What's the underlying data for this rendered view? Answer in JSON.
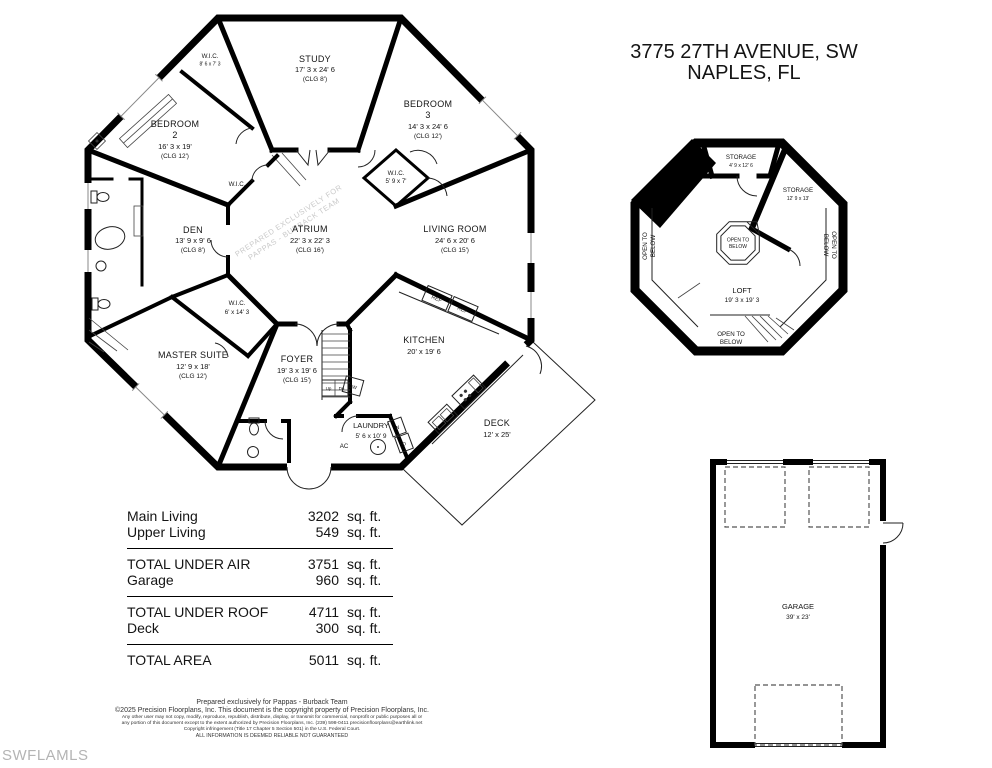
{
  "address": {
    "line1": "3775 27TH AVENUE, SW",
    "line2": "NAPLES, FL"
  },
  "mls_watermark": "SWFLAMLS",
  "main_floor": {
    "watermark": {
      "line1": "PREPARED EXCLUSIVELY FOR",
      "line2": "PAPPAS - BURBACK TEAM"
    },
    "rooms": {
      "study": {
        "name": "STUDY",
        "dims": "17' 3 x 24' 6",
        "clg": "(CLG 8')"
      },
      "bedroom2": {
        "name": "BEDROOM",
        "number": "2",
        "dims": "16' 3 x 19'",
        "clg": "(CLG 12')"
      },
      "bedroom3": {
        "name": "BEDROOM",
        "number": "3",
        "dims": "14' 3 x 24' 6",
        "clg": "(CLG 12')"
      },
      "wic_top": {
        "name": "W.I.C.",
        "dims": "8' 6 x 7' 3"
      },
      "wic_hall": {
        "name": "W.I.C."
      },
      "wic_bed3": {
        "name": "W.I.C.",
        "dims": "5' 9 x 7'"
      },
      "den": {
        "name": "DEN",
        "dims": "13' 9 x 9' 6",
        "clg": "(CLG 8')"
      },
      "atrium": {
        "name": "ATRIUM",
        "dims": "22' 3 x 22' 3",
        "clg": "(CLG 16')"
      },
      "living_room": {
        "name": "LIVING ROOM",
        "dims": "24' 6 x 20' 6",
        "clg": "(CLG 15')"
      },
      "wic_master": {
        "name": "W.I.C.",
        "dims": "6' x 14' 3"
      },
      "master_suite": {
        "name": "MASTER SUITE",
        "dims": "12' 9 x 18'",
        "clg": "(CLG 12')"
      },
      "foyer": {
        "name": "FOYER",
        "dims": "19' 3 x 19' 6",
        "clg": "(CLG 15')"
      },
      "kitchen": {
        "name": "KITCHEN",
        "dims": "20' x 19' 6"
      },
      "laundry": {
        "name": "LAUNDRY",
        "dims": "5' 6 x 10' 9"
      },
      "deck": {
        "name": "DECK",
        "dims": "12' x 25'"
      }
    },
    "labels": {
      "ref": "REF",
      "dw": "DW",
      "washer": "W",
      "dryer": "D",
      "ac": "AC",
      "up": "Up",
      "dn": "Dn"
    }
  },
  "upper_floor": {
    "rooms": {
      "storage1": {
        "name": "STORAGE",
        "dims": "4' 9 x 12' 6"
      },
      "storage2": {
        "name": "STORAGE",
        "dims": "12' 9 x 13'"
      },
      "loft": {
        "name": "LOFT",
        "dims": "19' 3 x 19' 3"
      }
    },
    "open_to": "OPEN TO",
    "below": "BELOW"
  },
  "garage_plan": {
    "name": "GARAGE",
    "dims": "39' x 23'"
  },
  "areas": {
    "rows": [
      {
        "label": "Main Living",
        "value": "3202",
        "unit": "sq. ft."
      },
      {
        "label": "Upper Living",
        "value": "549",
        "unit": "sq. ft."
      },
      {
        "label": "TOTAL UNDER AIR",
        "value": "3751",
        "unit": "sq. ft."
      },
      {
        "label": "Garage",
        "value": "960",
        "unit": "sq. ft."
      },
      {
        "label": "TOTAL UNDER ROOF",
        "value": "4711",
        "unit": "sq. ft."
      },
      {
        "label": "Deck",
        "value": "300",
        "unit": "sq. ft."
      },
      {
        "label": "TOTAL AREA",
        "value": "5011",
        "unit": "sq. ft."
      }
    ]
  },
  "footer": {
    "lines": [
      "Prepared exclusively for Pappas - Burback Team",
      "©2025 Precision Floorplans, Inc.  This document is the copyright property of Precision Floorplans, Inc.",
      "Any other user may not copy, modify, reproduce, republish, distribute, display, or transmit for commercial, nonprofit or public purposes all or",
      "any portion of this document except to the extent authorized by Precision Floorplans, Inc. (239) 598-0411 precisionfloorplans@earthlink.net",
      "Copyright infringement (Title 17 Chapter 5 Section 501) in the U.S. Federal Court.",
      "ALL INFORMATION IS DEEMED RELIABLE NOT GUARANTEED"
    ]
  }
}
